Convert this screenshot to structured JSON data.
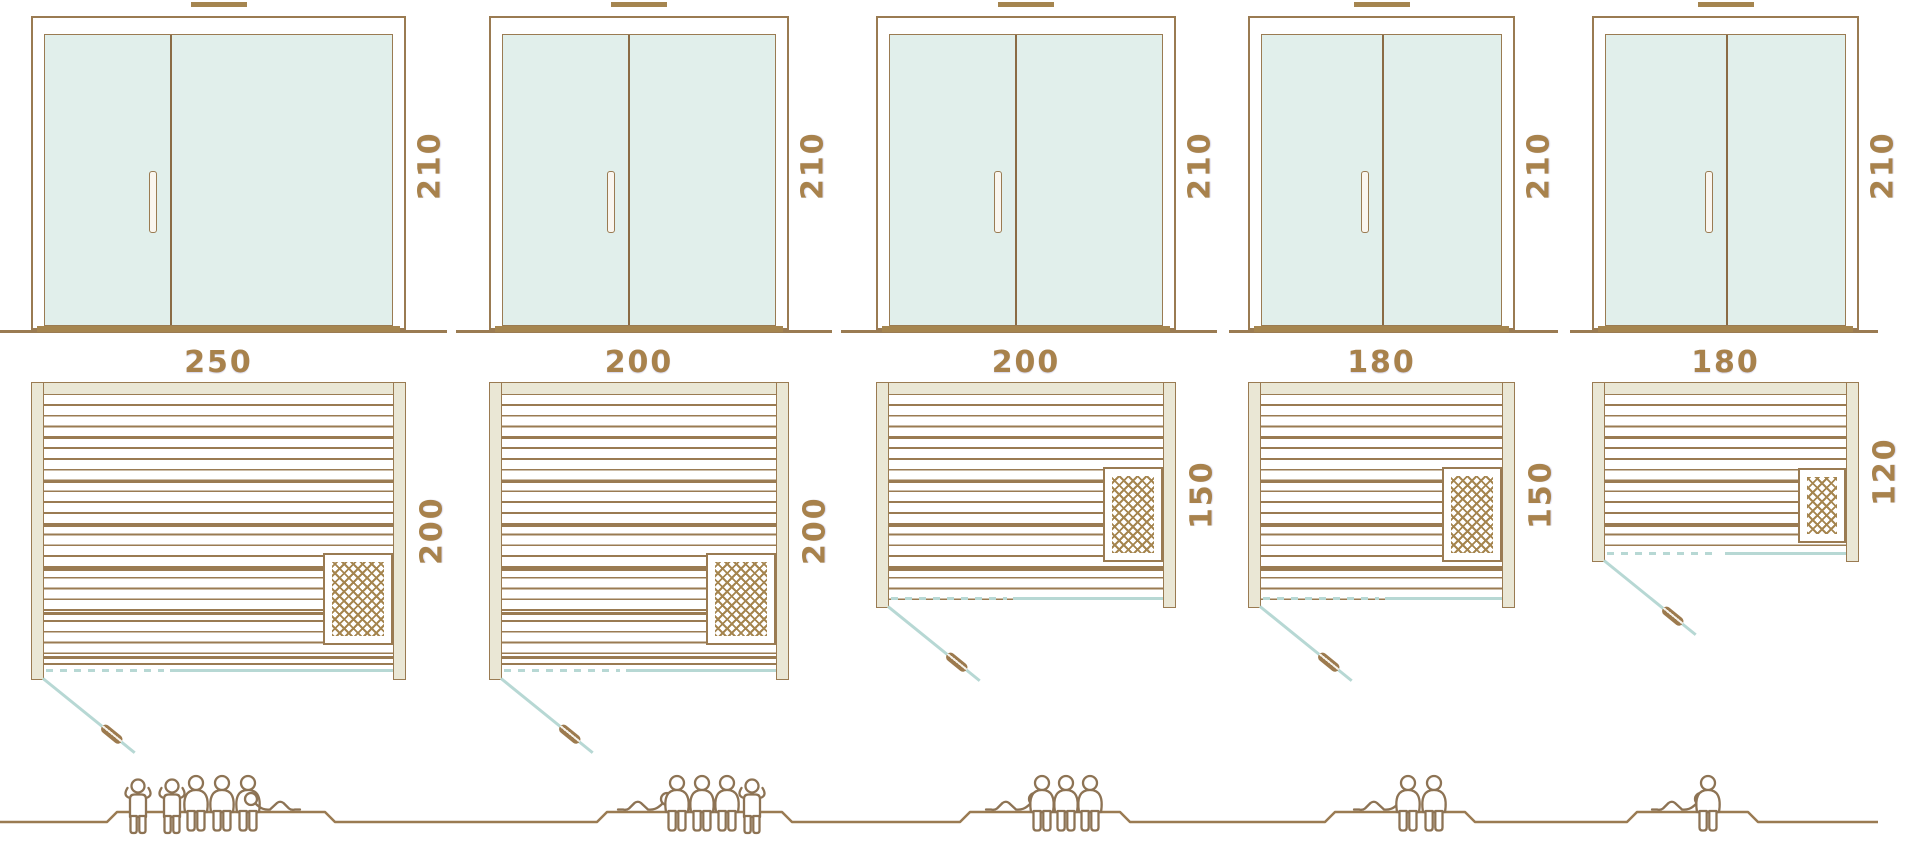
{
  "diagram": {
    "name": "sauna-size-comparison",
    "rows": [
      "door-front-elevation",
      "floor-plan",
      "capacity-figures"
    ],
    "units": "cm"
  },
  "colors": {
    "line_brown": "#9a7b52",
    "dark_brown_fill": "#a5854f",
    "dimension_text_gold": "#a8824c",
    "glass_mint": "#e1efeb",
    "teal_glass_line": "#b7d8d4",
    "wall_beige": "#eae7d5",
    "people_brown": "#8d7354"
  },
  "saunas": [
    {
      "name": "sauna-250x200",
      "width_cm": "250",
      "depth_cm": "200",
      "door_height_cm": "210",
      "capacity": 6,
      "figures": [
        "standing",
        "standing",
        "seated",
        "seated",
        "seated",
        "lying"
      ]
    },
    {
      "name": "sauna-200x200",
      "width_cm": "200",
      "depth_cm": "200",
      "door_height_cm": "210",
      "capacity": 5,
      "figures": [
        "lying",
        "seated",
        "seated",
        "seated",
        "standing"
      ]
    },
    {
      "name": "sauna-200x150",
      "width_cm": "200",
      "depth_cm": "150",
      "door_height_cm": "210",
      "capacity": 4,
      "figures": [
        "lying",
        "seated",
        "seated",
        "seated"
      ]
    },
    {
      "name": "sauna-180x150",
      "width_cm": "180",
      "depth_cm": "150",
      "door_height_cm": "210",
      "capacity": 3,
      "figures": [
        "lying",
        "seated",
        "seated"
      ]
    },
    {
      "name": "sauna-180x120",
      "width_cm": "180",
      "depth_cm": "120",
      "door_height_cm": "210",
      "capacity": 2,
      "figures": [
        "lying",
        "seated"
      ]
    }
  ]
}
